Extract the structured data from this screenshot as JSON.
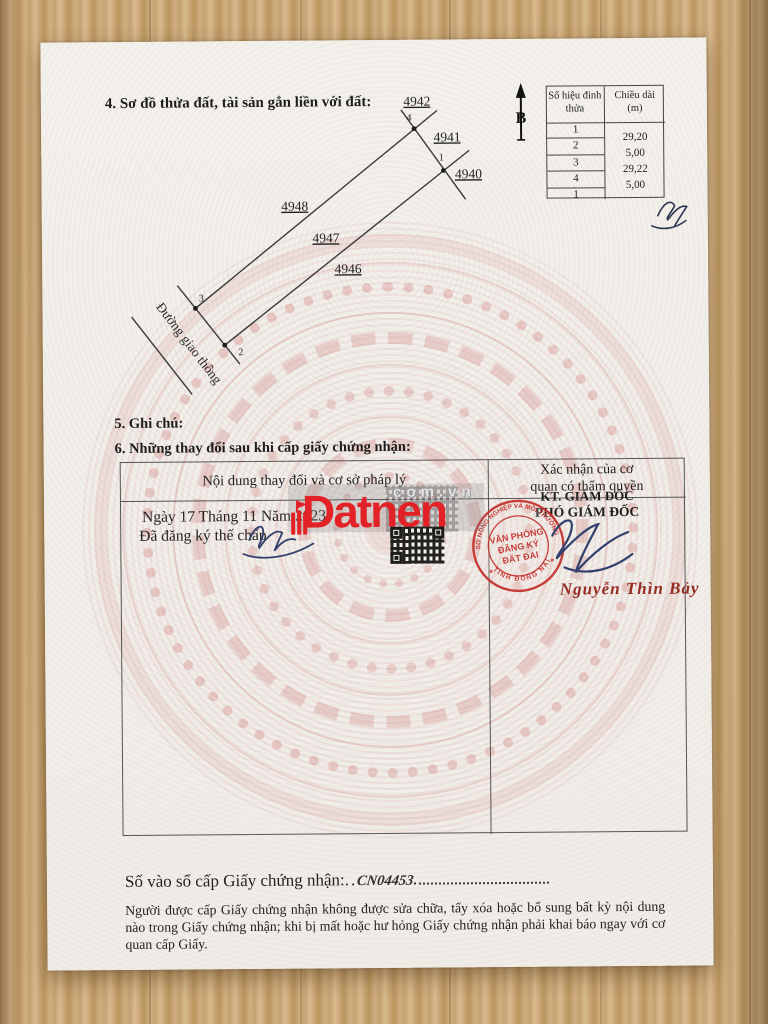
{
  "doc": {
    "title4": "4. Sơ đồ thửa đất, tài sản gắn liền với đất:",
    "section5": "5. Ghi chú:",
    "section6": "6. Những thay đổi sau khi cấp giấy chứng nhận:"
  },
  "diagram": {
    "north_label": "B",
    "road_label": "Đường giao thông",
    "plots": [
      "4942",
      "4941",
      "4940",
      "4948",
      "4947",
      "4946"
    ],
    "vertices": [
      "4",
      "1",
      "3",
      "2"
    ]
  },
  "length_table": {
    "header_vertex": "Số hiệu đỉnh thửa",
    "header_length_1": "Chiều dài",
    "header_length_2": "(m)",
    "vertex_numbers": [
      "1",
      "2",
      "3",
      "4",
      "1"
    ],
    "lengths": [
      "29,20",
      "5,00",
      "29,22",
      "5,00"
    ]
  },
  "changes_table": {
    "col1_header": "Nội dung thay đổi và cơ sở pháp lý",
    "col2_header_line1": "Xác nhận của cơ",
    "col2_header_line2": "quan có thẩm quyền",
    "entry_date_line": "Ngày 17 Tháng 11 Năm 2023",
    "entry_action_line": "Đã đăng ký thế chấp",
    "approver_title1": "KT. GIÁM ĐỐC",
    "approver_title2": "PHÓ GIÁM ĐỐC",
    "signer_name": "Nguyễn Thìn Bảy"
  },
  "stamp": {
    "arc_top": "SỞ NÔNG NGHIỆP VÀ MÔI TRƯỜNG",
    "arc_bottom": "TỈNH ĐỒNG NAI",
    "line1": "VĂN PHÒNG",
    "line2": "ĐĂNG KÝ",
    "line3": "ĐẤT ĐAI",
    "star_left": "★",
    "star_right": "★"
  },
  "watermark": {
    "text": "Datnen",
    "domain": ".com.vn"
  },
  "footer": {
    "serial_label": "Số vào sổ cấp Giấy chứng nhận:",
    "serial_value": "CN04453",
    "disclaimer_line1": "Người được cấp Giấy chứng nhận không được sửa chữa, tẩy xóa hoặc bổ sung bất kỳ nội dung nào trong",
    "disclaimer_line2": "Giấy chứng nhận; khi bị mất hoặc hư hỏng Giấy chứng nhận phải khai báo ngay với cơ quan cấp Giấy."
  },
  "colors": {
    "stamp_red": "#c5302c",
    "watermark_red": "#e32228",
    "signature_blue": "#32406e",
    "signer_red": "#942c24",
    "drum_pink": "#d98c88",
    "wood": "#c9a778"
  }
}
